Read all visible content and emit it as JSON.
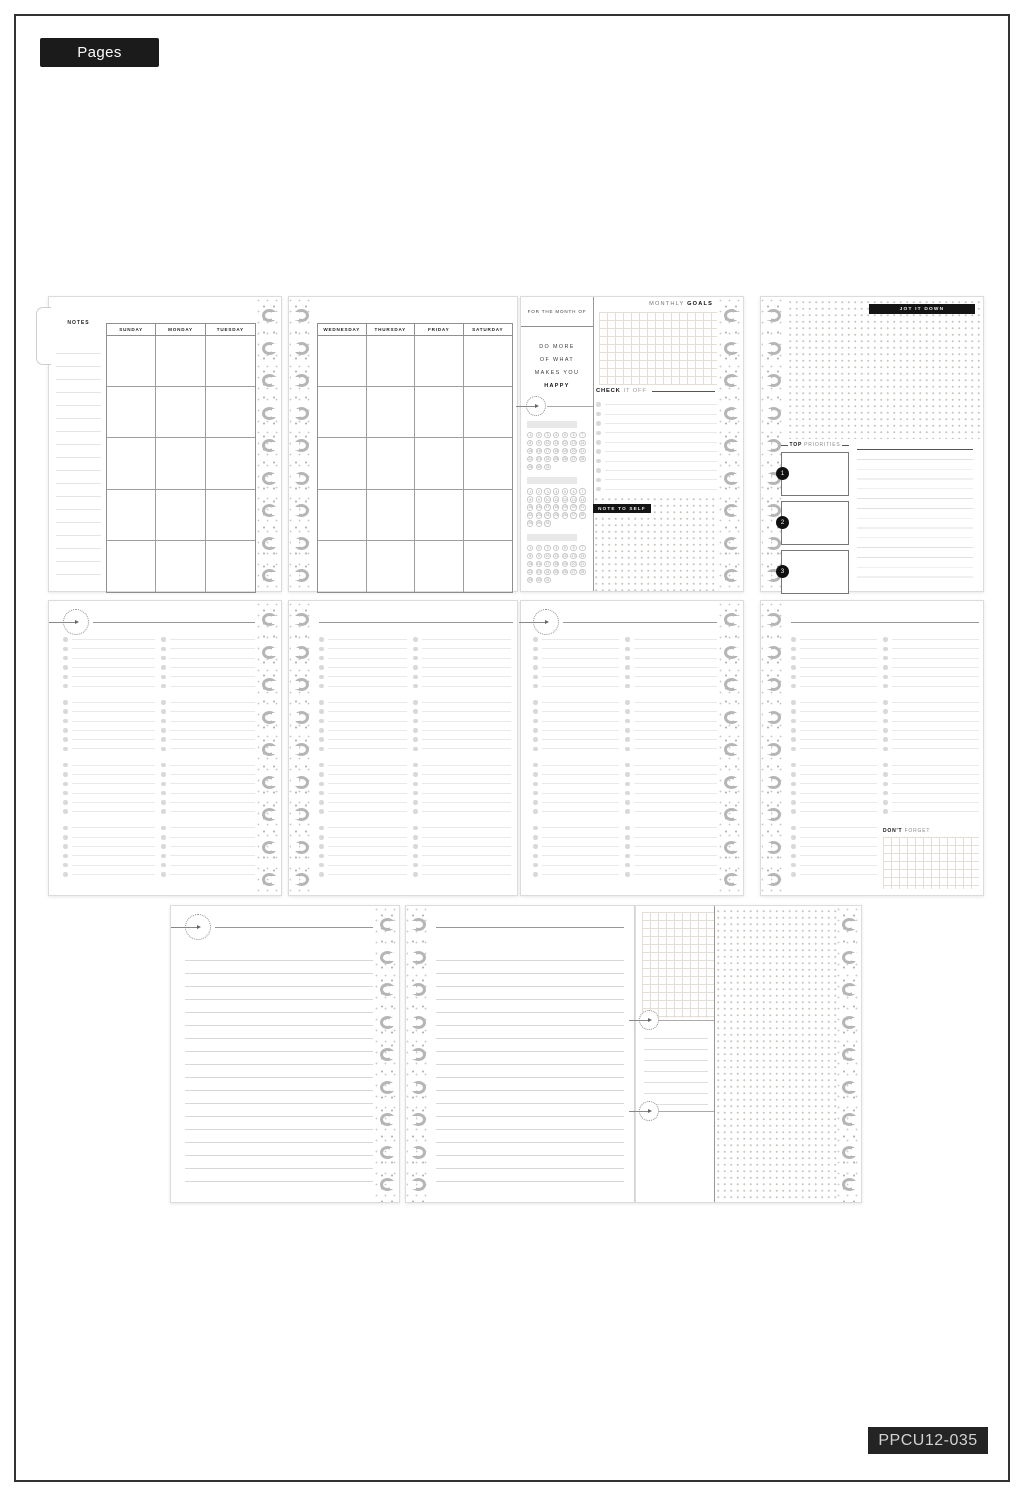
{
  "page_tab": "Pages",
  "sku": "PPCU12-035",
  "calendar": {
    "notes_label": "NOTES",
    "left_days": [
      "SUNDAY",
      "MONDAY",
      "TUESDAY"
    ],
    "right_days": [
      "WEDNESDAY",
      "THURSDAY",
      "FRIDAY",
      "SATURDAY"
    ]
  },
  "month_page": {
    "header": "FOR THE MONTH OF",
    "quote": [
      "DO MORE",
      "OF WHAT",
      "MAKES YOU",
      "HAPPY"
    ],
    "tracker_days": 31,
    "goals_title_light": "MONTHLY",
    "goals_title_bold": "GOALS",
    "check_bold": "CHECK",
    "check_light": "IT OFF",
    "note_label": "NOTE TO SELF"
  },
  "jot_page": {
    "label": "JOT IT DOWN",
    "priorities_bold": "TOP",
    "priorities_light": "PRIORITIES",
    "priority_numbers": [
      "1",
      "2",
      "3"
    ]
  },
  "reminders": {
    "dont_forget_bold": "DON'T",
    "dont_forget_light": "FORGET"
  },
  "colors": {
    "label_bg": "#1b1b1b",
    "page_bg": "#ffffff",
    "disc_gray": "#b6b6b6",
    "grid_line": "#e4ded7"
  }
}
